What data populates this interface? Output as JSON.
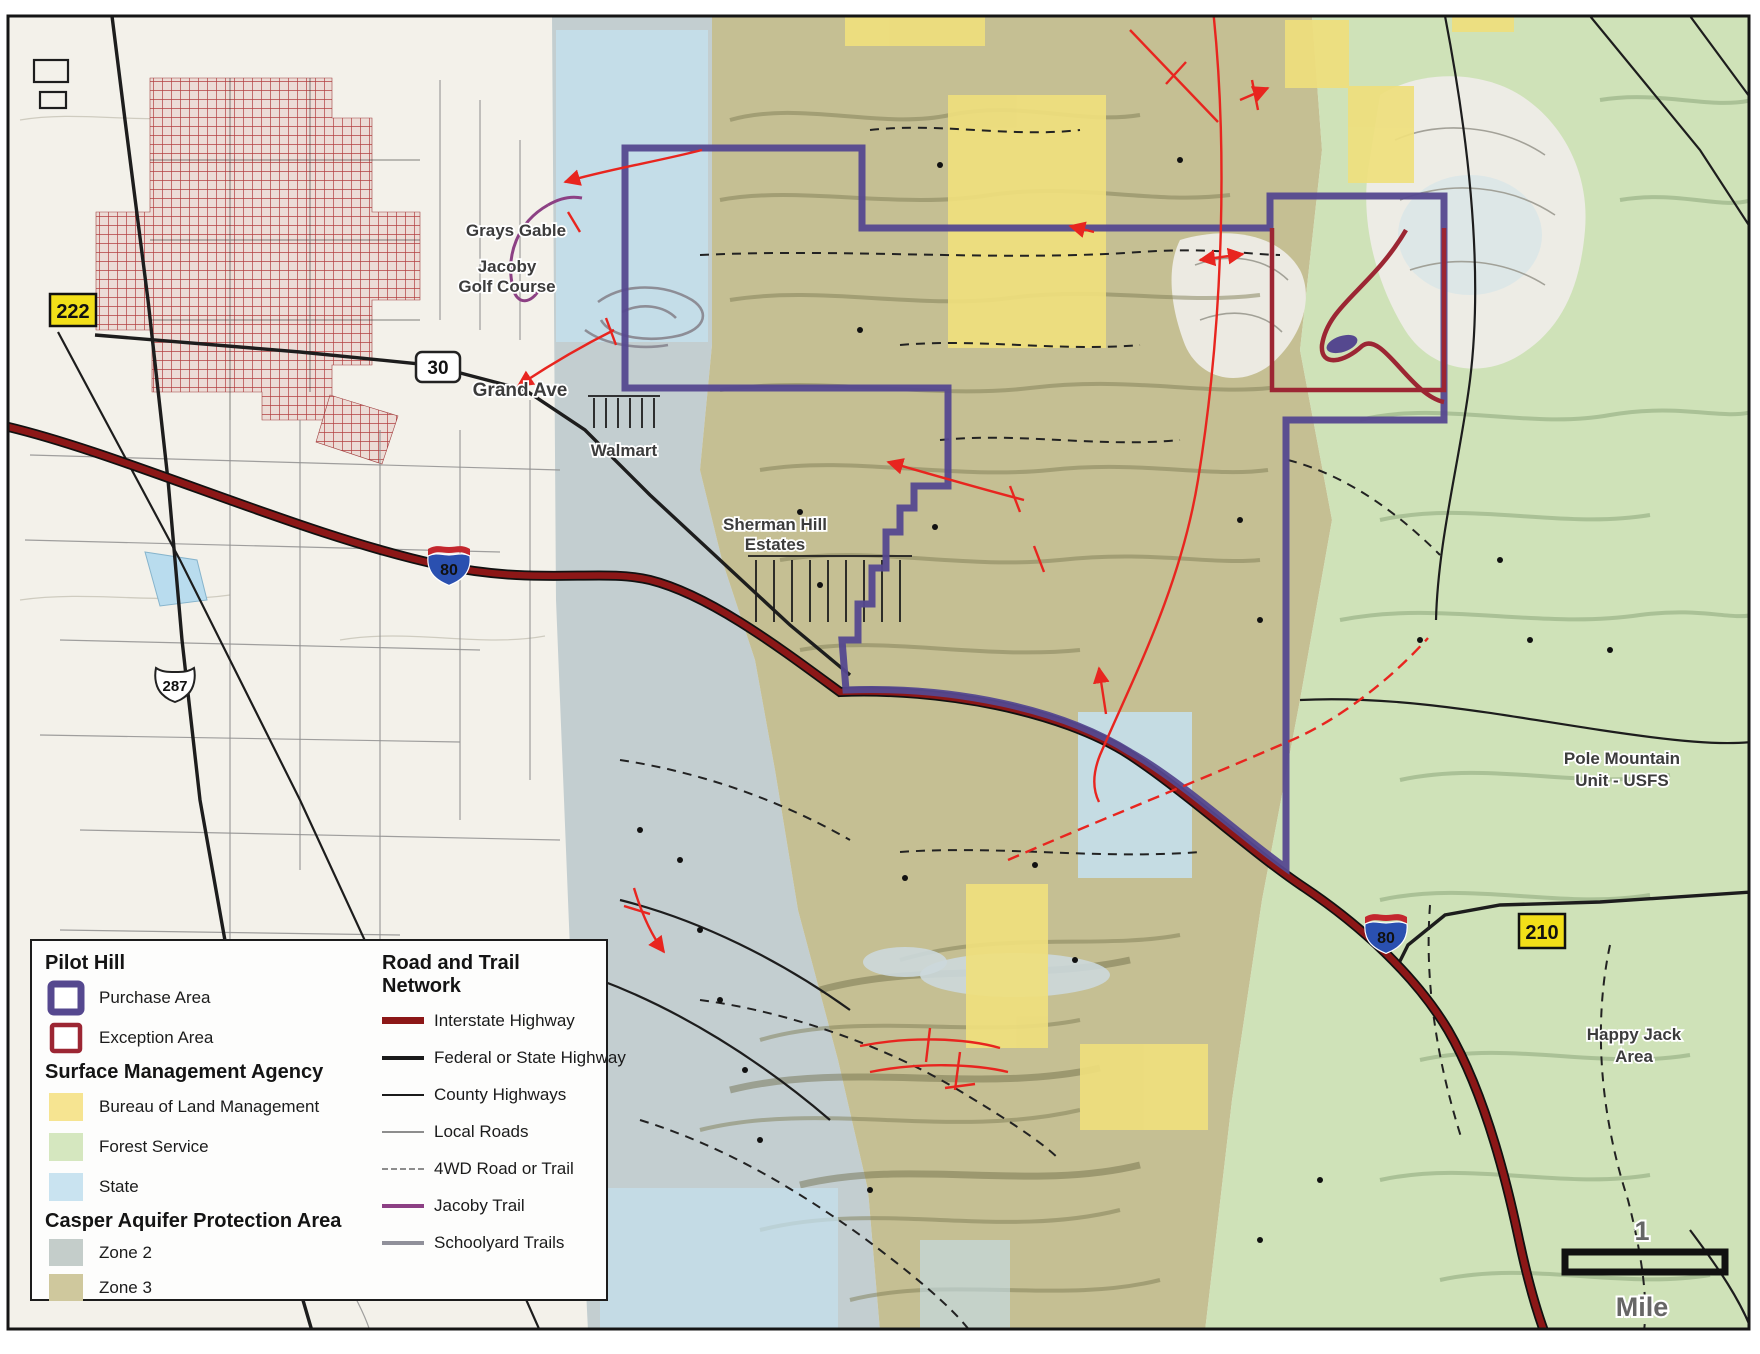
{
  "legend": {
    "pilot_hill": {
      "heading": "Pilot Hill",
      "purchase": "Purchase Area",
      "exception": "Exception Area"
    },
    "sma": {
      "heading": "Surface Management Agency",
      "blm": "Bureau of Land Management",
      "forest": "Forest Service",
      "state": "State"
    },
    "capa": {
      "heading": "Casper Aquifer Protection Area",
      "zone2": "Zone 2",
      "zone3": "Zone 3"
    },
    "roads": {
      "heading": "Road and Trail Network",
      "interstate": "Interstate Highway",
      "federal": "Federal or State Highway",
      "county": "County Highways",
      "local": "Local Roads",
      "fwd": "4WD Road or Trail",
      "jacoby": "Jacoby Trail",
      "schoolyard": "Schoolyard Trails"
    }
  },
  "map_labels": {
    "grays_gable": "Grays Gable",
    "jacoby_line1": "Jacoby",
    "jacoby_line2": "Golf Course",
    "grand_ave": "Grand Ave",
    "walmart": "Walmart",
    "sherman_line1": "Sherman Hill",
    "sherman_line2": "Estates",
    "pole_line1": "Pole Mountain",
    "pole_line2": "Unit - USFS",
    "happy_line1": "Happy Jack",
    "happy_line2": "Area"
  },
  "shields": {
    "wy222": "222",
    "us30": "30",
    "us287": "287",
    "i80": "80",
    "wy210": "210"
  },
  "scale_bar": {
    "value": "1",
    "unit": "Mile"
  },
  "colors": {
    "purchase": "#55488f",
    "exception": "#9c2633",
    "blm_yellow": "#f6e491",
    "forest_green": "#d5e7bf",
    "state_blue": "#c9e3f0",
    "zone2_gray": "#c4cdca",
    "zone3_tan": "#cfc89d",
    "map_zone2": "#c3ced0",
    "map_zone3": "#c5bf93",
    "map_forest": "#cfe2b8",
    "map_state": "#c4dfec",
    "map_blm": "#efdf7d",
    "interstate_red": "#8c1717",
    "fault_red": "#e8251f",
    "jacoby_purple": "#8c4084",
    "schoolyard_gray": "#90909a",
    "city_red": "#b34040",
    "shield_yellow": "#f2df19"
  }
}
